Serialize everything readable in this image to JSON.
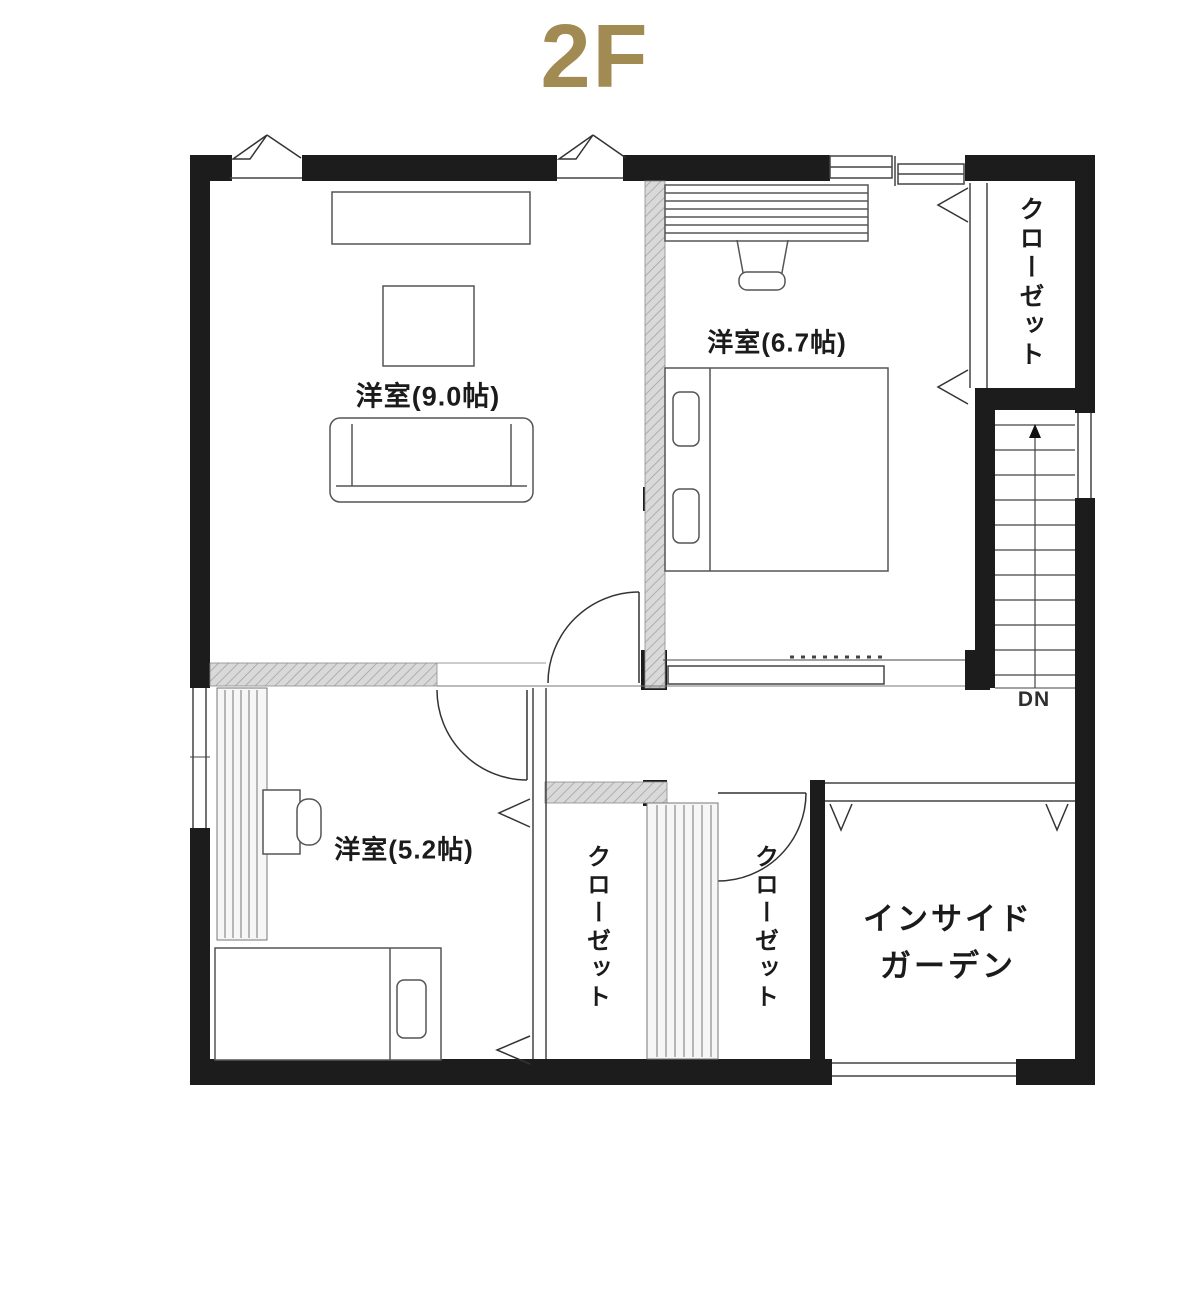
{
  "title": "2F",
  "colors": {
    "title_gold": "#a28b52",
    "wall": "#1c1c1c",
    "thin_line": "#444444"
  },
  "plan": {
    "rooms": {
      "western_room_9": {
        "label": "洋室(9.0帖)"
      },
      "western_room_6_7": {
        "label": "洋室(6.7帖)"
      },
      "western_room_5_2": {
        "label": "洋室(5.2帖)"
      },
      "closet_upper": {
        "label": "クローゼット"
      },
      "closet_lower_left": {
        "label": "クローゼット"
      },
      "closet_lower_right": {
        "label": "クローゼット"
      },
      "inside_garden": {
        "label_line1": "インサイド",
        "label_line2": "ガーデン"
      },
      "stairs": {
        "direction_label": "DN"
      }
    }
  }
}
